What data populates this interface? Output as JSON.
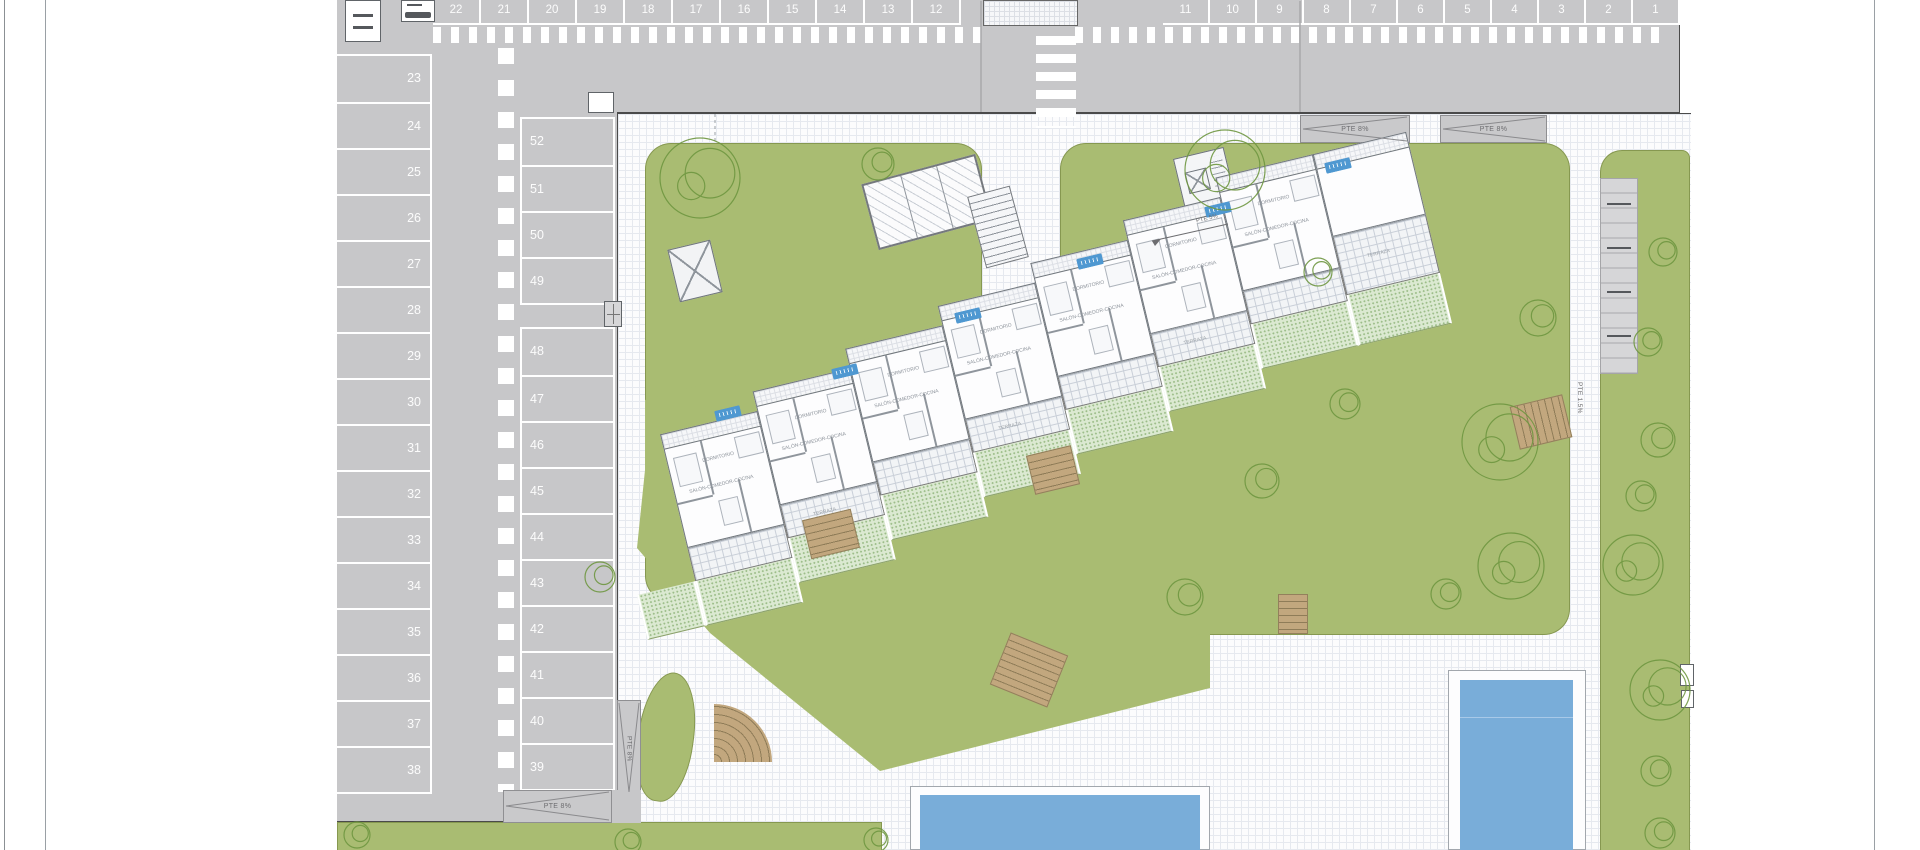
{
  "plan": {
    "type": "residential site plan",
    "features": [
      "parking",
      "apartment building",
      "gardens",
      "pools"
    ]
  },
  "parking": {
    "row_top_left": [
      "22",
      "21",
      "20",
      "19",
      "18",
      "17",
      "16",
      "15",
      "14",
      "13",
      "12"
    ],
    "row_top_right": [
      "11",
      "10",
      "9",
      "8",
      "7",
      "6",
      "5",
      "4",
      "3",
      "2",
      "1"
    ],
    "col_left": [
      "23",
      "24",
      "25",
      "26",
      "27",
      "28",
      "29",
      "30",
      "31",
      "32",
      "33",
      "34",
      "35",
      "36",
      "37",
      "38"
    ],
    "col_mid_upper": [
      "52",
      "51",
      "50",
      "49"
    ],
    "col_mid_lower": [
      "48",
      "47",
      "46",
      "45",
      "44",
      "43",
      "42",
      "41",
      "40",
      "39"
    ]
  },
  "labels": {
    "ramp_8": "PTE 8%",
    "ramp_5": "PTE 5%",
    "ramp_15": "PTE 1.5%",
    "room_living": "SALÓN-COMEDOR-COCINA",
    "room_bed": "DORMITORIO",
    "terrace": "TERRAZA"
  },
  "colors": {
    "lawn": "#a9bc72",
    "private_garden": "#dbe9d1",
    "asphalt": "#c7c7c9",
    "pool_water": "#79add9",
    "unit_marker_blue": "#4f98d1",
    "stair_wood": "#c2a77e"
  },
  "counts": {
    "parking_spaces": 52,
    "pools": 2,
    "building_modules": 7,
    "unit_markers": 6
  }
}
